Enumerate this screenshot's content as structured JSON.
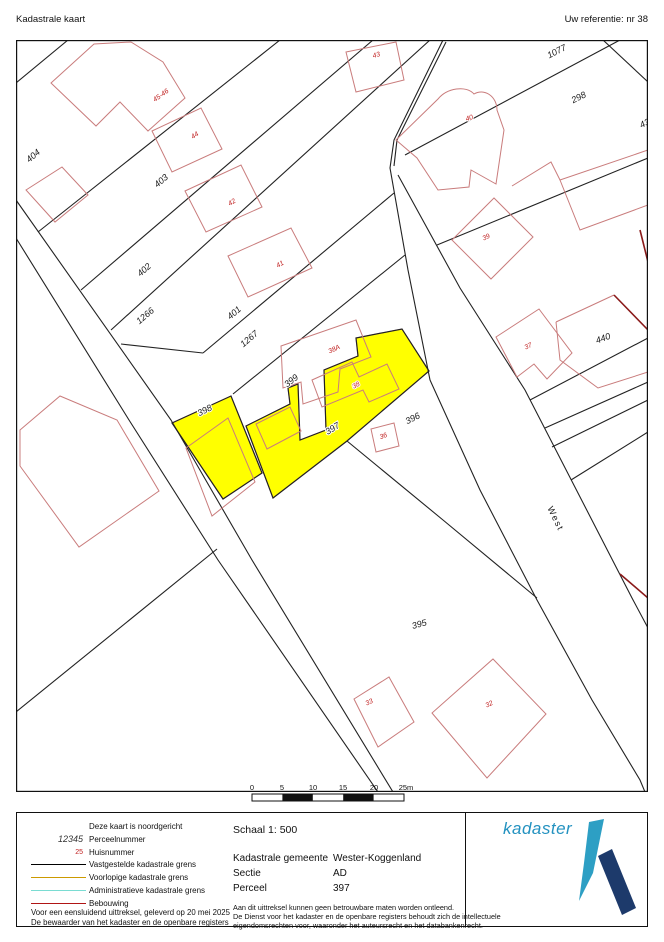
{
  "header": {
    "left": "Kadastrale kaart",
    "right": "Uw referentie: nr 38"
  },
  "map": {
    "parcel_labels": [
      {
        "text": "404",
        "x": 35,
        "y": 158,
        "rot": -40
      },
      {
        "text": "403",
        "x": 163,
        "y": 183,
        "rot": -40
      },
      {
        "text": "402",
        "x": 146,
        "y": 272,
        "rot": -41
      },
      {
        "text": "1266",
        "x": 147,
        "y": 318,
        "rot": -40
      },
      {
        "text": "401",
        "x": 236,
        "y": 315,
        "rot": -40
      },
      {
        "text": "1267",
        "x": 251,
        "y": 341,
        "rot": -40
      },
      {
        "text": "399",
        "x": 293,
        "y": 383,
        "rot": -38
      },
      {
        "text": "398",
        "x": 206,
        "y": 413,
        "rot": -27
      },
      {
        "text": "397",
        "x": 334,
        "y": 431,
        "rot": -32
      },
      {
        "text": "396",
        "x": 414,
        "y": 421,
        "rot": -27
      },
      {
        "text": "1077",
        "x": 558,
        "y": 54,
        "rot": -27
      },
      {
        "text": "298",
        "x": 580,
        "y": 100,
        "rot": -27
      },
      {
        "text": "440",
        "x": 604,
        "y": 341,
        "rot": -20
      },
      {
        "text": "395",
        "x": 420,
        "y": 627,
        "rot": -15
      },
      {
        "text": "43",
        "x": 646,
        "y": 126,
        "rot": -27
      }
    ],
    "house_labels": [
      {
        "text": "45-46",
        "x": 162,
        "y": 97,
        "rot": -35
      },
      {
        "text": "44",
        "x": 196,
        "y": 137,
        "rot": -35
      },
      {
        "text": "42",
        "x": 233,
        "y": 204,
        "rot": -32
      },
      {
        "text": "41",
        "x": 281,
        "y": 266,
        "rot": -30
      },
      {
        "text": "43",
        "x": 377,
        "y": 57,
        "rot": -18
      },
      {
        "text": "40",
        "x": 470,
        "y": 120,
        "rot": -20
      },
      {
        "text": "39",
        "x": 487,
        "y": 239,
        "rot": -25
      },
      {
        "text": "38A",
        "x": 335,
        "y": 351,
        "rot": -25
      },
      {
        "text": "38",
        "x": 357,
        "y": 387,
        "rot": -30
      },
      {
        "text": "36",
        "x": 384,
        "y": 438,
        "rot": -20
      },
      {
        "text": "37",
        "x": 529,
        "y": 348,
        "rot": -25
      },
      {
        "text": "33",
        "x": 370,
        "y": 704,
        "rot": -25
      },
      {
        "text": "32",
        "x": 490,
        "y": 706,
        "rot": -25
      }
    ],
    "street_label": {
      "text": "West",
      "x": 553,
      "y": 520,
      "rot": 64
    }
  },
  "scalebar": {
    "labels": [
      {
        "text": "0",
        "x": 252
      },
      {
        "text": "5",
        "x": 282
      },
      {
        "text": "10",
        "x": 313
      },
      {
        "text": "15",
        "x": 343
      },
      {
        "text": "20",
        "x": 374
      },
      {
        "text": "25m",
        "x": 406
      }
    ]
  },
  "legend": {
    "north_note": "Deze kaart is noordgericht",
    "parcel_sample": "12345",
    "parcel_sample_label": "Perceelnummer",
    "house_sample": "25",
    "house_sample_label": "Huisnummer",
    "line_items": [
      {
        "label": "Vastgestelde kadastrale grens",
        "color": "#000000"
      },
      {
        "label": "Voorlopige kadastrale grens",
        "color": "#cc9a00"
      },
      {
        "label": "Administratieve kadastrale grens",
        "color": "#7adcd2"
      },
      {
        "label": "Bebouwing",
        "color": "#b01515"
      }
    ],
    "footer_lines": [
      "Voor een eensluidend uittreksel, geleverd op 20 mei 2025",
      "De bewaarder van het kadaster en de openbare registers"
    ]
  },
  "info": {
    "scale_label": "Schaal 1: 500",
    "rows": [
      {
        "label": "Kadastrale gemeente",
        "value": "Wester-Koggenland"
      },
      {
        "label": "Sectie",
        "value": "AD"
      },
      {
        "label": "Perceel",
        "value": "397"
      }
    ],
    "disclaimer_lines": [
      "Aan dit uittreksel kunnen geen betrouwbare maten worden ontleend.",
      "De Dienst voor het kadaster en de openbare registers behoudt zich de intellectuele",
      "eigendomsrechten voor, waaronder het auteursrecht en het databankenrecht."
    ]
  },
  "logo": {
    "text": "kadaster"
  },
  "colors": {
    "highlight": "#ffff00",
    "building": "#c97c7c",
    "building_dark": "#8a1a1a",
    "parcel_text": "#1a1a1a",
    "house_text": "#c02020",
    "logo_light": "#2d9fc4",
    "logo_dark": "#1d3a6b",
    "logo_text": "#2492c0"
  }
}
